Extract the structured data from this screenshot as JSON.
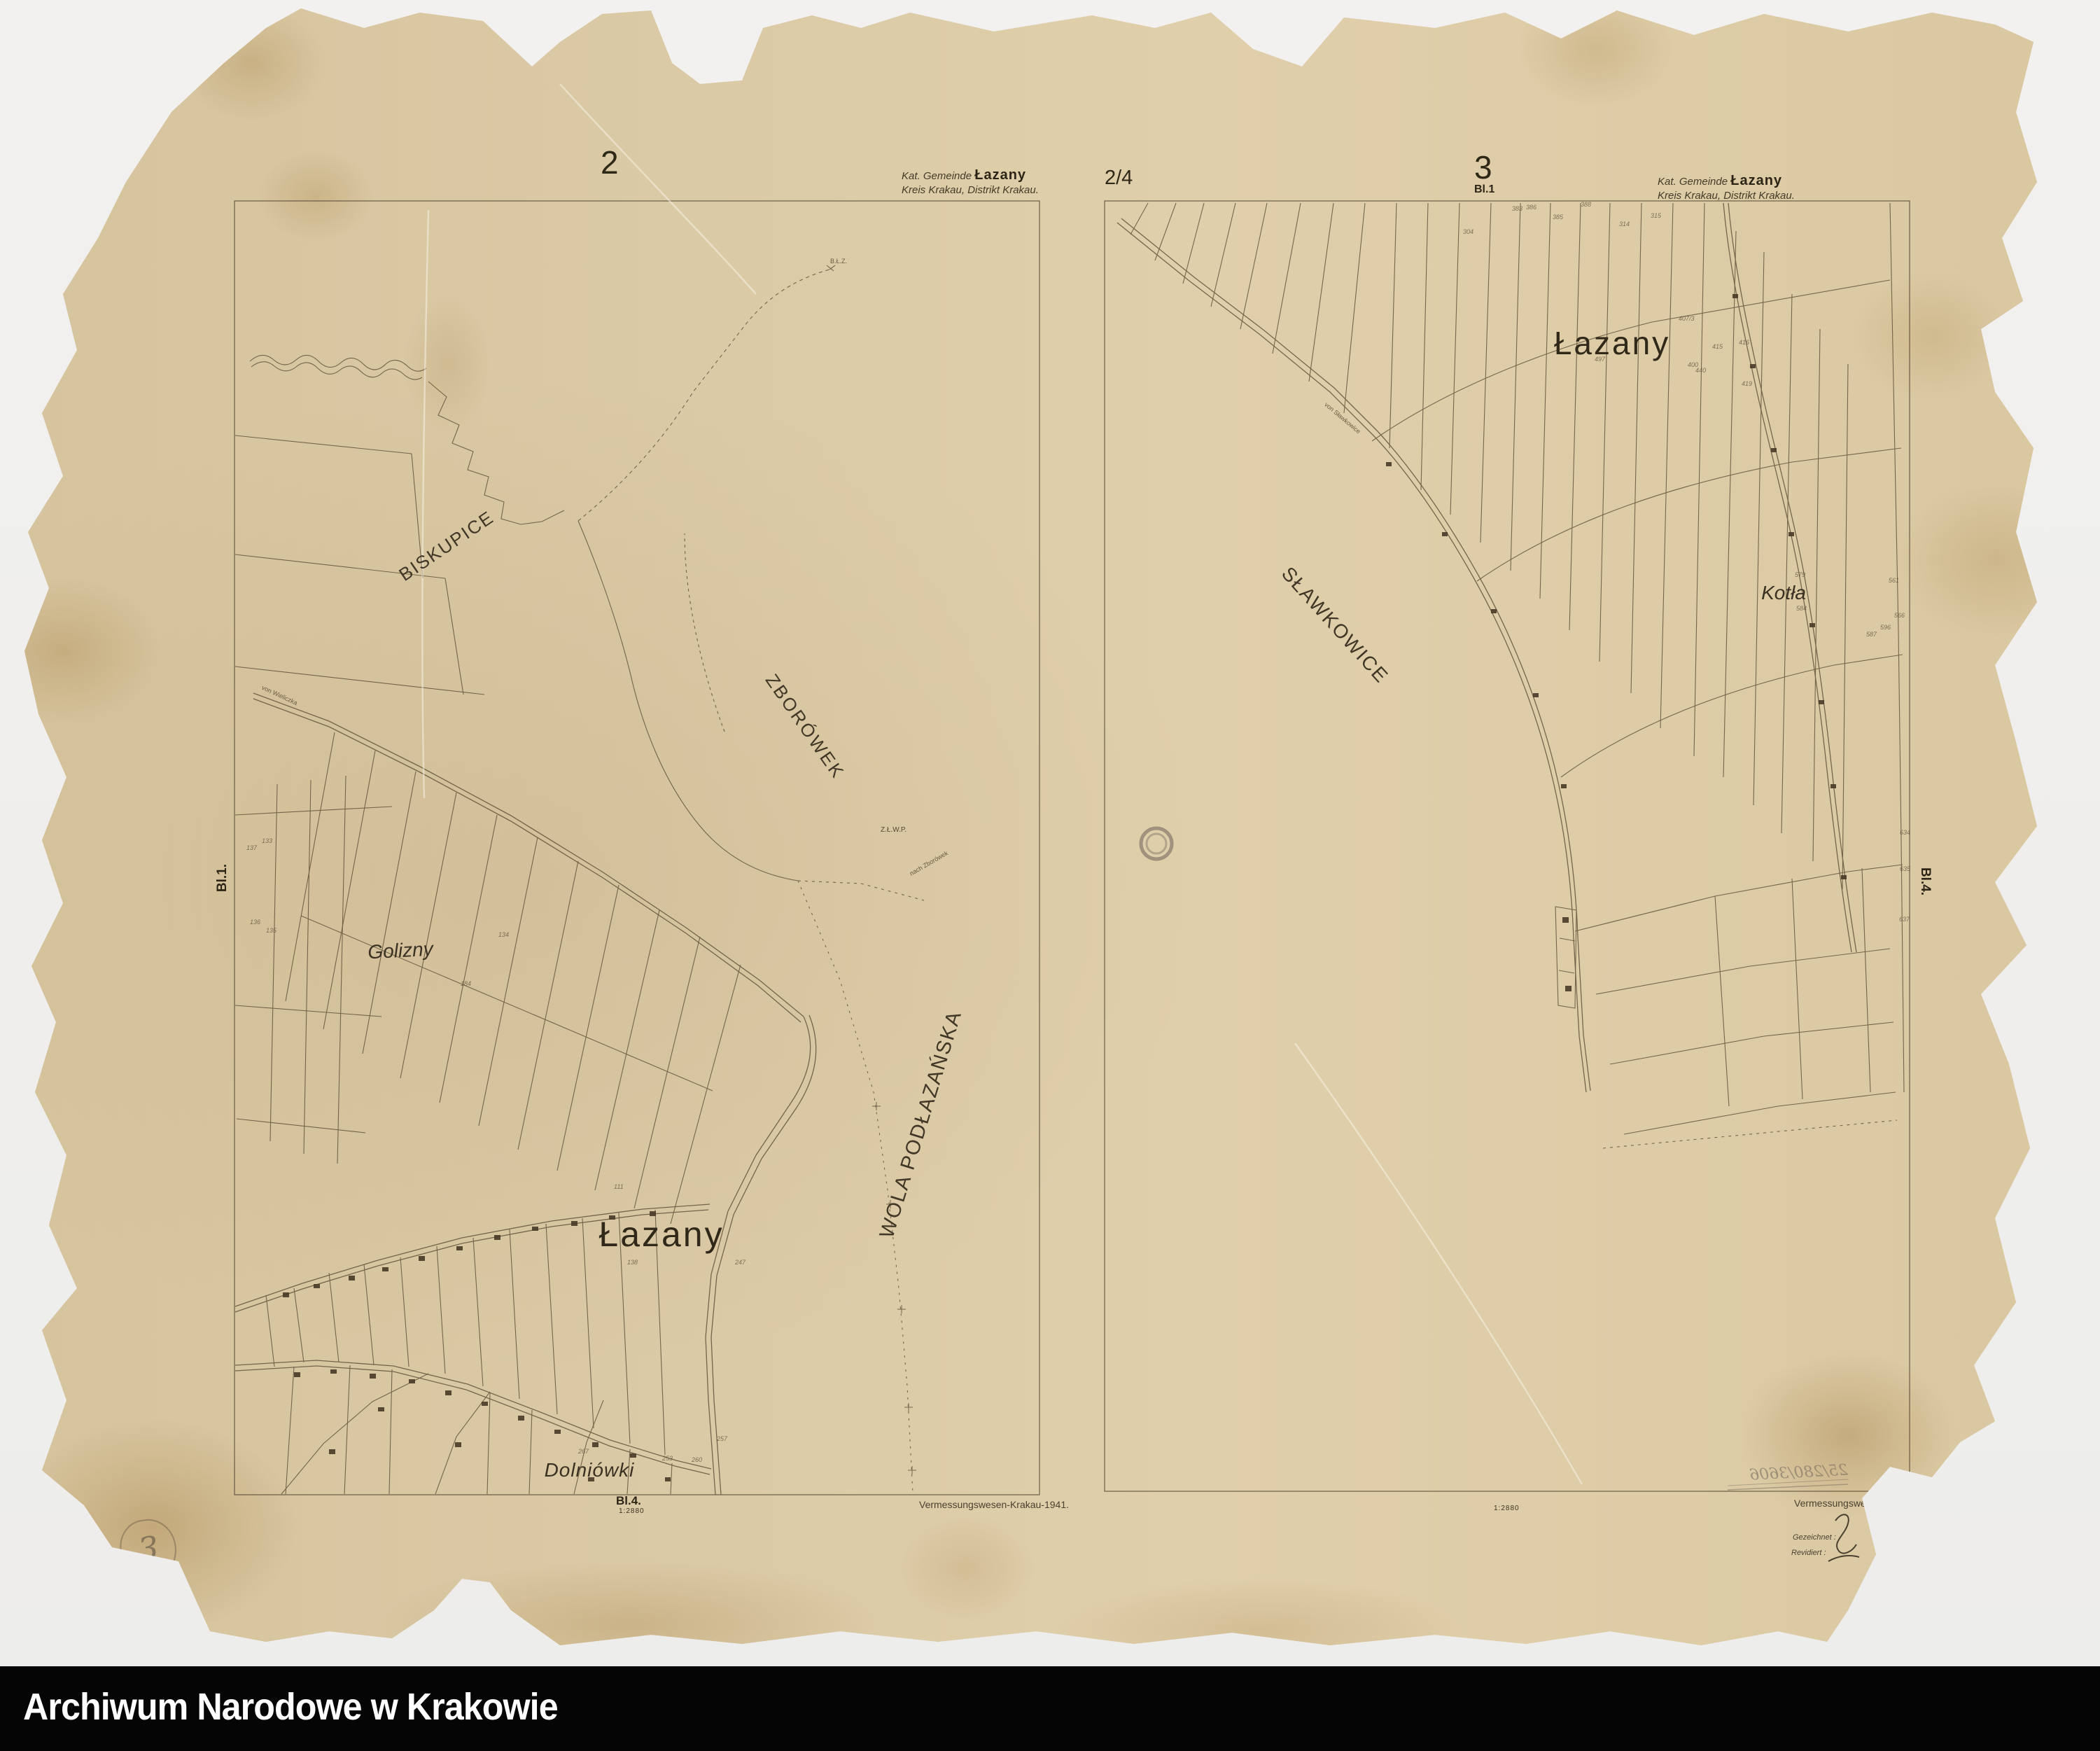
{
  "archive_bar": {
    "label": "Archiwum Narodowe w Krakowie"
  },
  "sheets": {
    "left": {
      "sheet_number": "2",
      "header_prefix": "Kat. Gemeinde",
      "header_gemeinde": "Łazany",
      "header_line2": "Kreis Krakau, Distrikt Krakau.",
      "edge_label_left": "Bl.1.",
      "bottom_label": "Bl.4.",
      "scale": "1:2880",
      "credit": "Vermessungswesen-Krakau-1941.",
      "pencil_note": "3",
      "labels": {
        "biskupice": "BISKUPICE",
        "zborowek": "ZBORÓWEK",
        "wola": "WOLA PODŁAZAŃSKA",
        "golizny": "Golizny",
        "lazany": "Łazany",
        "dolniowki": "Dolniówki",
        "road_from": "von Wieliczka",
        "path_marker": "B.Ł.Z.",
        "zlwp": "Z.Ł.W.P.",
        "nach_zborowek": "nach Zborówek"
      },
      "parcel_numbers": [
        [
          "137",
          352,
          1206
        ],
        [
          "133",
          374,
          1196
        ],
        [
          "136",
          357,
          1312
        ],
        [
          "135",
          380,
          1324
        ],
        [
          "134",
          712,
          1330
        ],
        [
          "184",
          658,
          1400
        ],
        [
          "111",
          877,
          1690
        ],
        [
          "138",
          896,
          1798
        ],
        [
          "247",
          1050,
          1798
        ],
        [
          "267",
          826,
          2068
        ],
        [
          "253",
          946,
          2078
        ],
        [
          "260",
          988,
          2080
        ],
        [
          "257",
          1024,
          2050
        ]
      ]
    },
    "right": {
      "sheet_fraction": "2/4",
      "sheet_number": "3",
      "sheet_sub": "Bl.1",
      "header_prefix": "Kat. Gemeinde",
      "header_gemeinde": "Łazany",
      "header_line2": "Kreis Krakau, Distrikt Krakau.",
      "edge_label_right": "Bl.4.",
      "scale": "1:2880",
      "labels": {
        "lazany": "Łazany",
        "slawkowice": "SŁAWKOWICE",
        "kotla": "Kotła",
        "road_from": "von Sławkowice"
      },
      "bottom_right": {
        "credit_cut": "Vermessungswe",
        "gezeichnet": "Gezeichnet :",
        "revidiert": "Revidiert :",
        "pencil_mirrored": "25/280/3606"
      },
      "parcel_numbers": [
        [
          "383",
          2160,
          293
        ],
        [
          "386",
          2180,
          291
        ],
        [
          "385",
          2218,
          305
        ],
        [
          "388",
          2258,
          287
        ],
        [
          "314",
          2313,
          315
        ],
        [
          "315",
          2358,
          303
        ],
        [
          "304",
          2090,
          326
        ],
        [
          "497",
          2278,
          508
        ],
        [
          "407/3",
          2398,
          450
        ],
        [
          "400",
          2411,
          516
        ],
        [
          "440",
          2422,
          524
        ],
        [
          "415",
          2446,
          490
        ],
        [
          "416",
          2484,
          484
        ],
        [
          "419",
          2488,
          543
        ],
        [
          "579",
          2564,
          816
        ],
        [
          "584",
          2566,
          864
        ],
        [
          "561",
          2698,
          824
        ],
        [
          "566",
          2706,
          874
        ],
        [
          "596",
          2686,
          891
        ],
        [
          "587",
          2666,
          901
        ],
        [
          "634",
          2714,
          1184
        ],
        [
          "635",
          2714,
          1236
        ],
        [
          "637",
          2713,
          1308
        ]
      ]
    }
  }
}
